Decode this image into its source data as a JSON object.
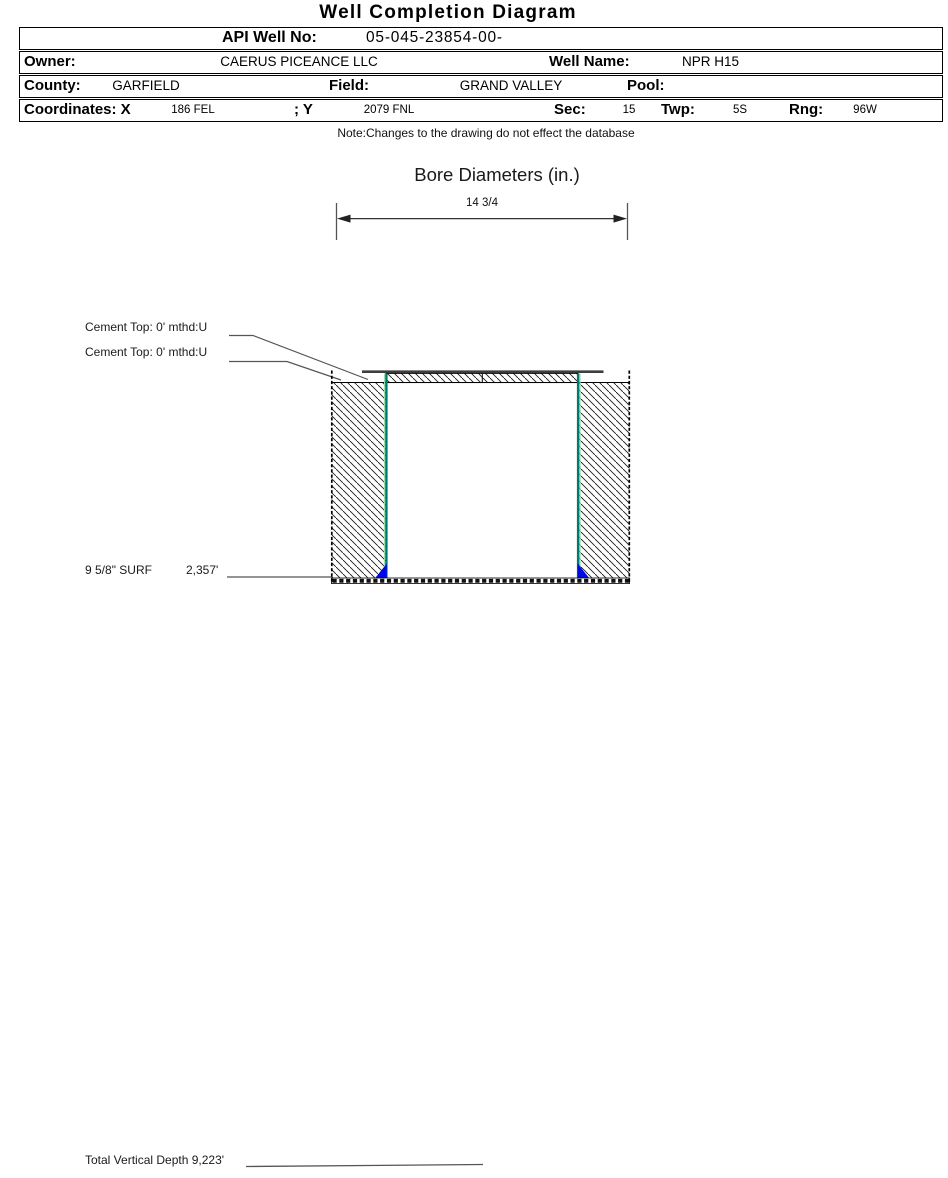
{
  "header": {
    "title": "Well Completion Diagram"
  },
  "table": {
    "api_label": "API Well No:",
    "api_value": "05-045-23854-00-",
    "owner_label": "Owner:",
    "owner_value": "CAERUS PICEANCE LLC",
    "well_name_label": "Well Name:",
    "well_name_value": "NPR H15",
    "county_label": "County:",
    "county_value": "GARFIELD",
    "field_label": "Field:",
    "field_value": "GRAND VALLEY",
    "pool_label": "Pool:",
    "coordinates_label": "Coordinates: X",
    "x_value": "186 FEL",
    "y_label": "; Y",
    "y_value": "2079 FNL",
    "sec_label": "Sec:",
    "sec_value": "15",
    "twp_label": "Twp:",
    "twp_value": "5S",
    "rng_label": "Rng:",
    "rng_value": "96W"
  },
  "note": "Note:Changes to the drawing do not effect the database",
  "bore": {
    "title": "Bore Diameters (in.)",
    "dimension": "14 3/4"
  },
  "annotations": {
    "cement_top_1": "Cement Top: 0' mthd:U",
    "cement_top_2": "Cement Top: 0' mthd:U",
    "casing_size": "9 5/8\" SURF",
    "casing_depth": "2,357'",
    "total_vertical_depth": "Total Vertical Depth 9,223'"
  },
  "colors": {
    "casing_line": "#007a6e",
    "casing_shoe": "#0008e8"
  }
}
